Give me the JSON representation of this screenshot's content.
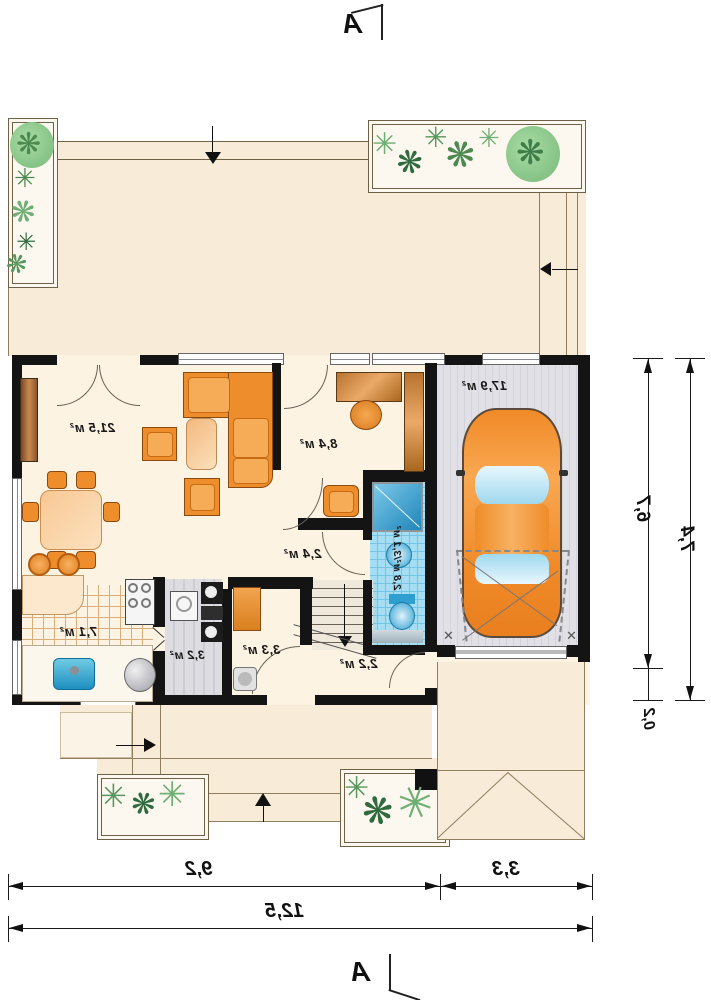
{
  "meta": {
    "drawing": "house ground-floor plan, mirrored print"
  },
  "section_markers": {
    "top": "A",
    "bottom": "A"
  },
  "rooms": {
    "living": {
      "label": "21,5 м²"
    },
    "office": {
      "label": "8,4 м²"
    },
    "hall": {
      "label": "2,4 м²"
    },
    "kitchen": {
      "label": "7,1 м²"
    },
    "utility": {
      "label": "3,2 м²"
    },
    "wc": {
      "label": "3,3 м²"
    },
    "entry": {
      "label": "2,2 м²"
    },
    "bathroom": {
      "label": "2,8 м²/3,1 м²"
    },
    "garage": {
      "label": "17,9 м²"
    }
  },
  "dimensions": {
    "bottom_left_width": "9,2",
    "bottom_right_width": "3,3",
    "bottom_total_width": "12,5",
    "right_inner_depth": "6,7",
    "right_outer_depth": "7,4",
    "right_small": "0,2"
  },
  "icons": {
    "plant_star": "✳",
    "plant_propeller": "❋",
    "cross": "✕"
  },
  "colors": {
    "terrace": "#f8ecd9",
    "interior": "#fdf3e3",
    "wall": "#141414",
    "furniture_orange": "#ee8d2c",
    "wood": "#b8742f",
    "plant_green": "#6faf72",
    "tile_blue": "#a5ddf2",
    "fixture_blue": "#2f9fd0",
    "garage_floor": "#e0e0e6",
    "car_orange": "#f08a28",
    "dimension": "#111111"
  }
}
